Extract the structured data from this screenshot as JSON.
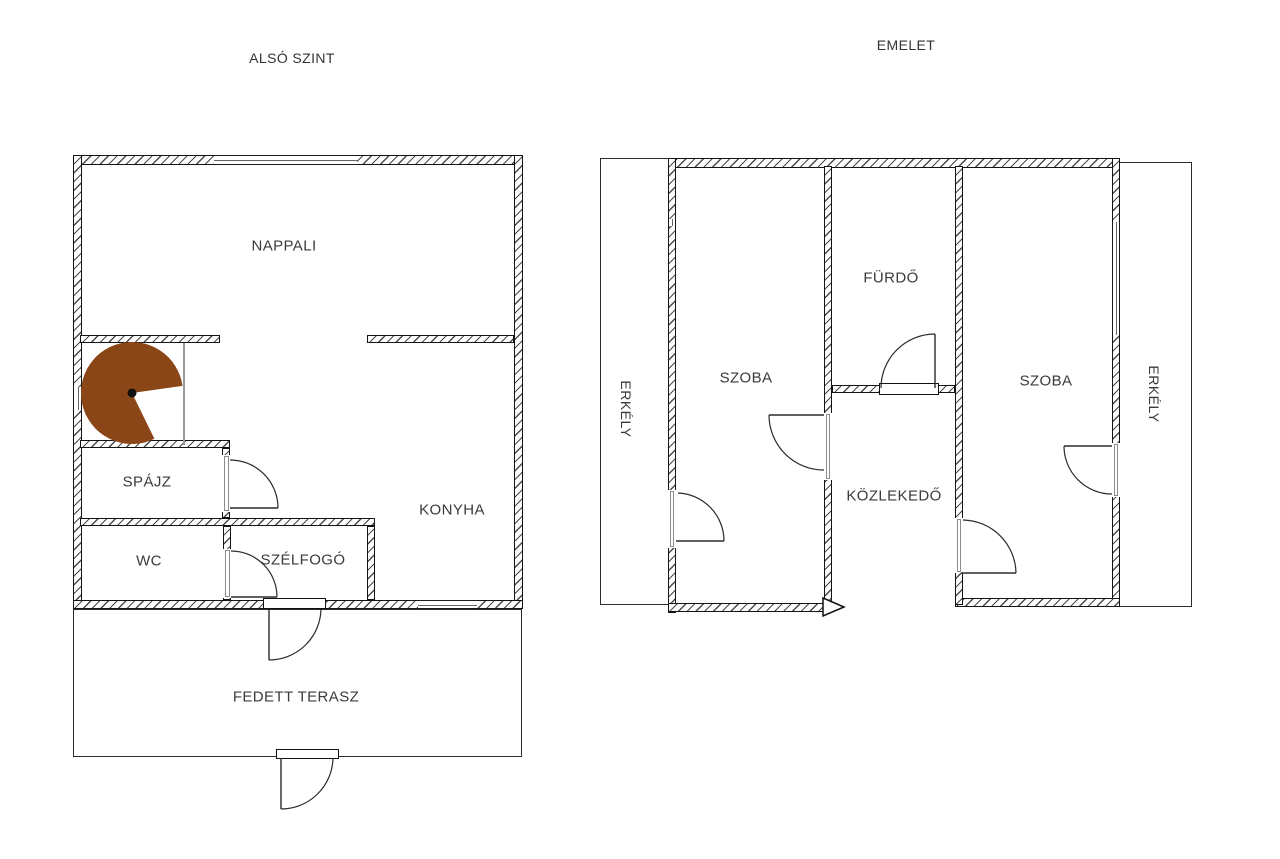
{
  "document": {
    "type": "floor-plan",
    "language": "Hungarian"
  },
  "colors": {
    "background": "#ffffff",
    "wall_line": "#141414",
    "hatch": "#4a4a4a",
    "stair_brown": "#8a4617",
    "text": "#3a3a3a"
  },
  "lower_level": {
    "title": "ALSÓ SZINT",
    "rooms": {
      "nappali": "NAPPALI",
      "spajz": "SPÁJZ",
      "wc": "WC",
      "szelfogo": "SZÉLFOGÓ",
      "konyha": "KONYHA",
      "terasz": "FEDETT TERASZ"
    },
    "features": {
      "staircase": "spiral-staircase"
    }
  },
  "upper_level": {
    "title": "EMELET",
    "rooms": {
      "szoba_left": "SZOBA",
      "furdo": "FÜRDŐ",
      "szoba_right": "SZOBA",
      "kozlekedo": "KÖZLEKEDŐ",
      "erkely_left": "ERKÉLY",
      "erkely_right": "ERKÉLY"
    }
  }
}
